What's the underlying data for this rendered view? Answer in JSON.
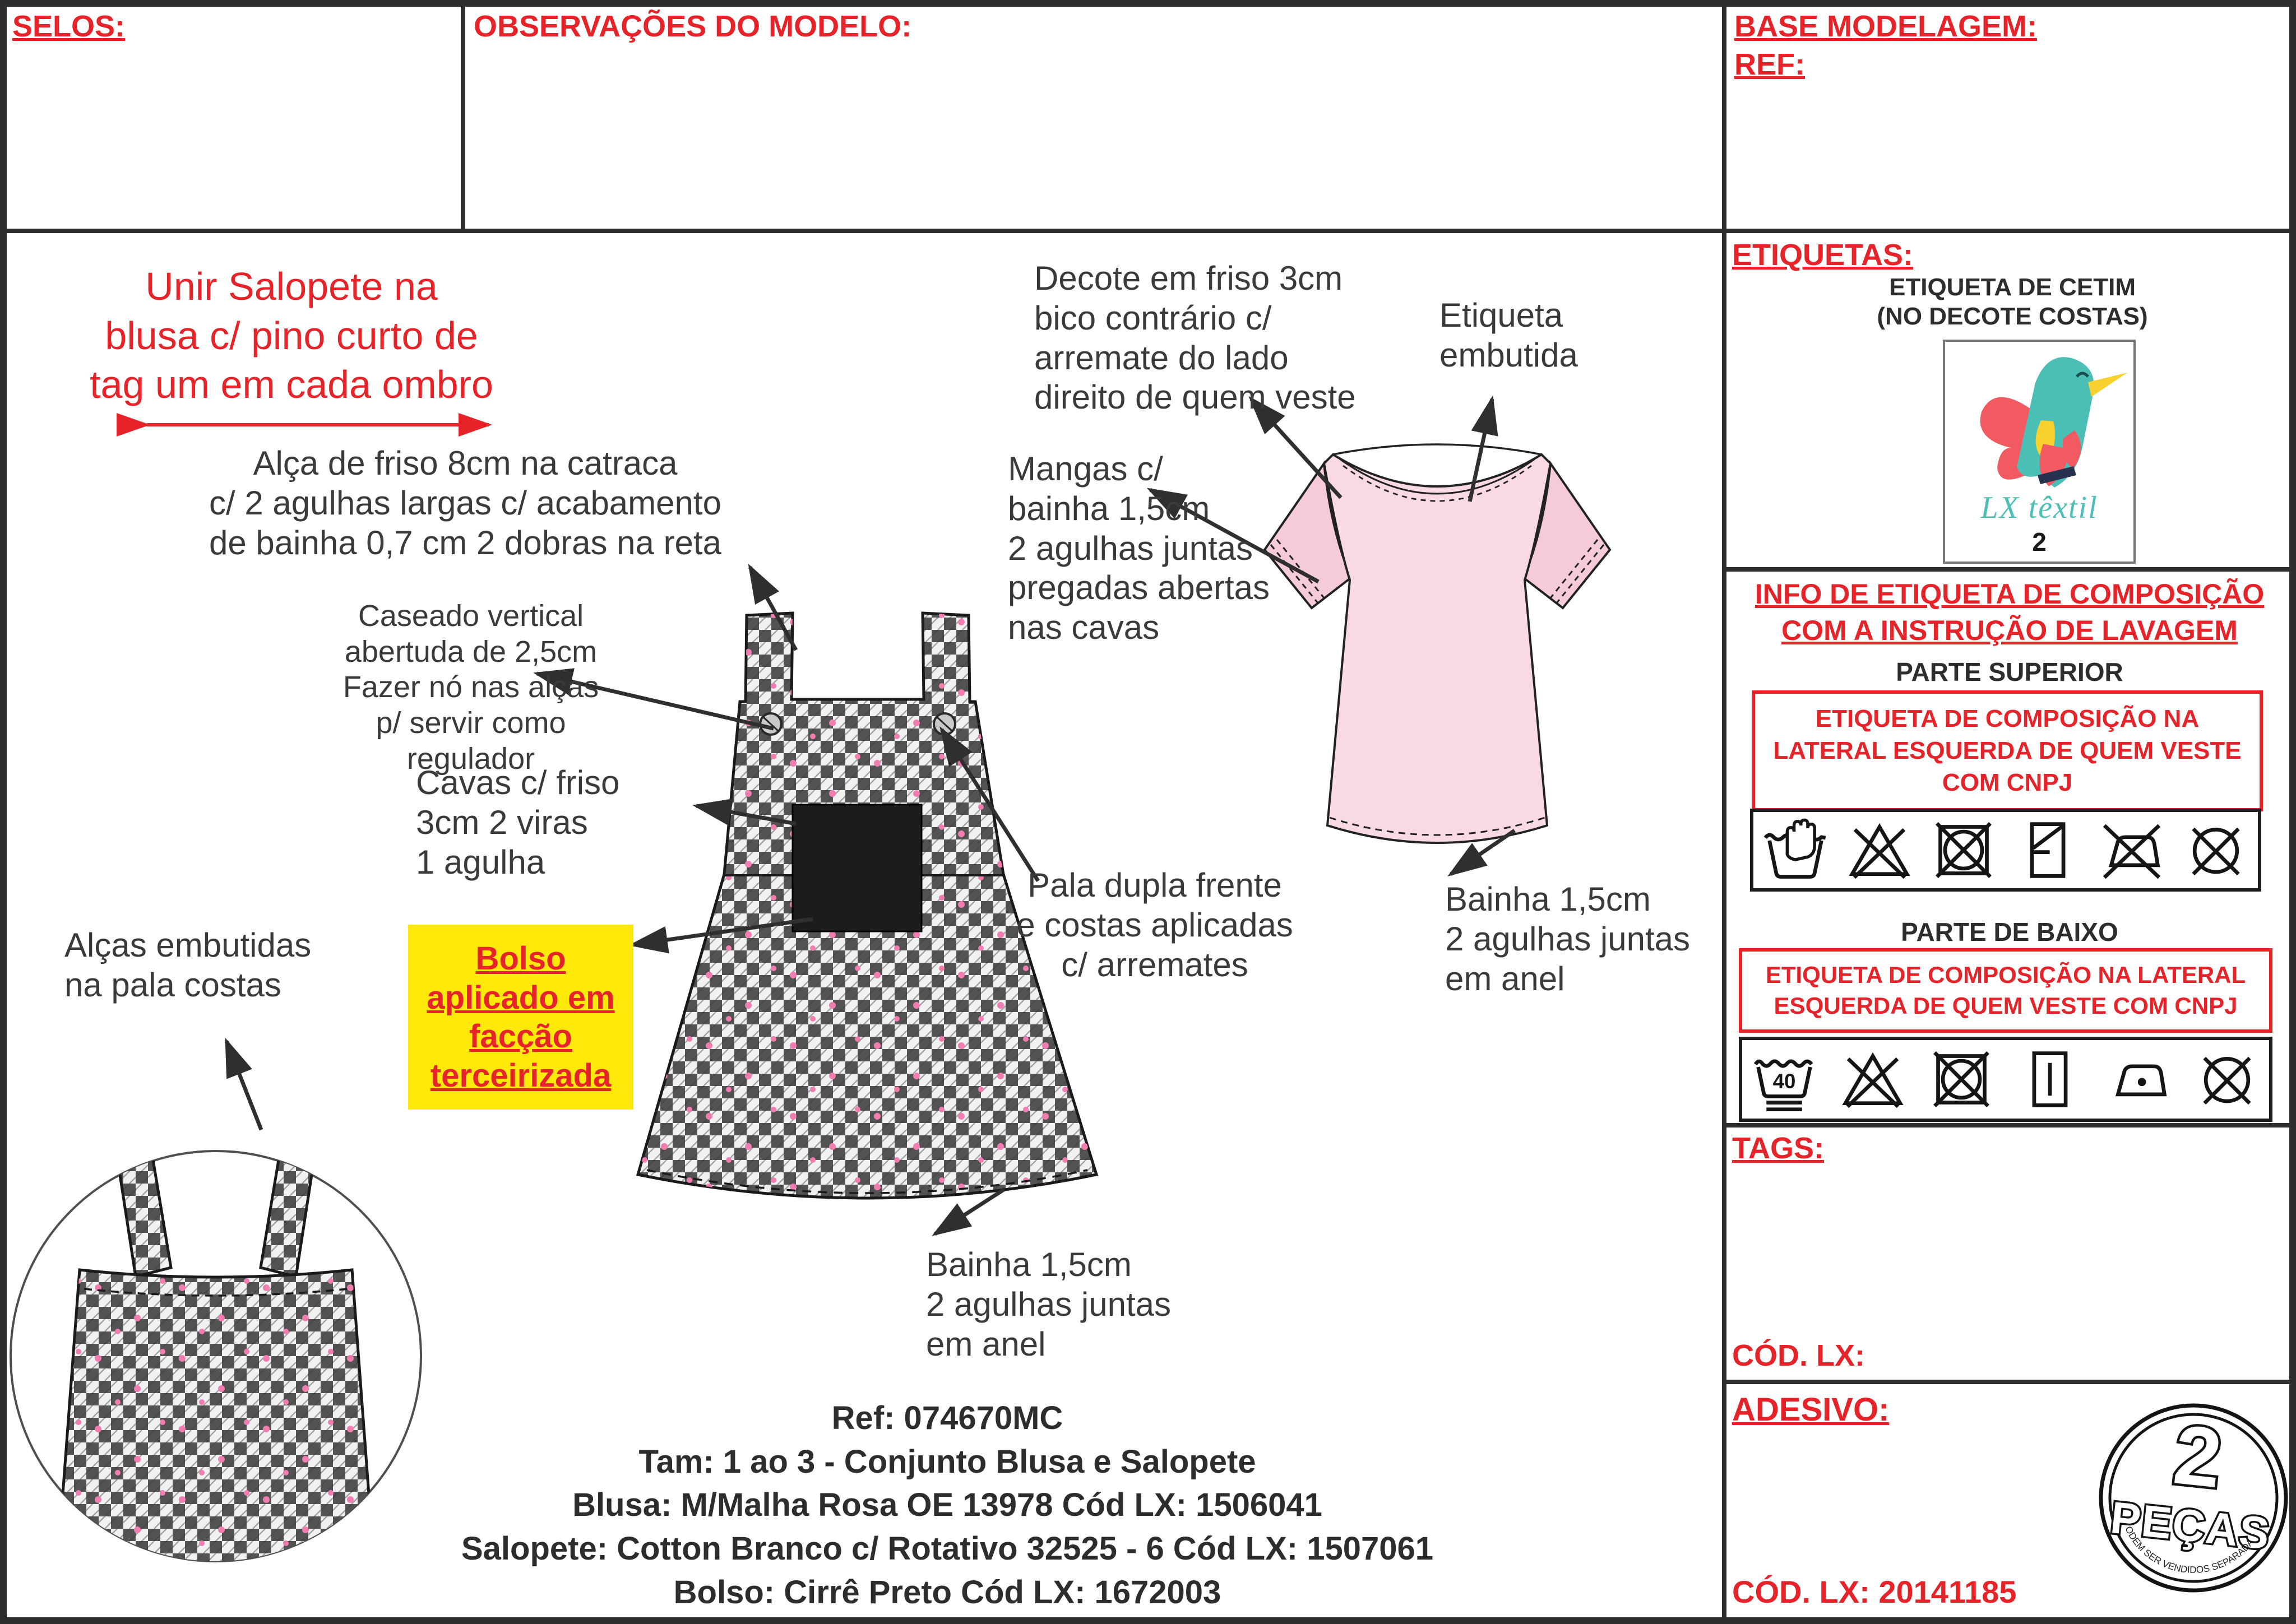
{
  "header": {
    "selos_label": "SELOS:",
    "observacoes_label": "OBSERVAÇÕES DO MODELO:",
    "base_modelagem_label": "BASE MODELAGEM:",
    "ref_label": "REF:"
  },
  "annotations": {
    "unir": "Unir Salopete na\nblusa c/ pino curto de\ntag um em cada ombro",
    "alca": "Alça de friso 8cm na catraca\nc/ 2 agulhas largas c/ acabamento\nde bainha 0,7 cm 2 dobras na reta",
    "caseado": "Caseado vertical\nabertuda de 2,5cm\nFazer nó nas alças\np/ servir como\nregulador",
    "cavas": "Cavas c/ friso\n3cm  2 viras\n1 agulha",
    "decote": "Decote em friso 3cm\nbico contrário c/\narremate do lado\ndireito de quem veste",
    "etiqueta_embutida": "Etiqueta\nembutida",
    "mangas": "Mangas c/\nbainha 1,5cm\n2 agulhas juntas\npregadas abertas\nnas cavas",
    "pala": "Pala dupla frente\ne costas aplicadas\nc/ arremates",
    "bainha_blusa": "Bainha 1,5cm\n2 agulhas juntas\nem anel",
    "bainha_salopete": "Bainha 1,5cm\n2 agulhas juntas\nem anel",
    "alcas_embutidas": "Alças embutidas\nna pala costas",
    "bolso": "Bolso\naplicado em \nfacção\nterceirizada"
  },
  "footer": {
    "lines": [
      "Ref: 074670MC",
      "Tam: 1 ao 3 - Conjunto Blusa e Salopete",
      "Blusa: M/Malha Rosa OE 13978 Cód LX: 1506041",
      "Salopete: Cotton Branco c/ Rotativo 32525 - 6 Cód LX: 1507061",
      "Bolso:  Cirrê Preto Cód LX: 1672003"
    ]
  },
  "sidebar": {
    "etiquetas": {
      "label": "ETIQUETAS:",
      "title": "ETIQUETA DE CETIM",
      "subtitle": "(NO DECOTE COSTAS)",
      "brand": "LX têxtil",
      "brand_number": "2"
    },
    "info": {
      "title": "INFO DE ETIQUETA DE COMPOSIÇÃO\nCOM A INSTRUÇÃO DE LAVAGEM",
      "parte_superior": {
        "label": "PARTE SUPERIOR",
        "note": "ETIQUETA DE COMPOSIÇÃO NA\nLATERAL ESQUERDA DE QUEM VESTE\nCOM CNPJ",
        "care_symbols": [
          "hand-wash",
          "do-not-bleach",
          "do-not-tumble-dry",
          "dry-flat-shade",
          "do-not-iron",
          "do-not-dry-clean"
        ]
      },
      "parte_baixo": {
        "label": "PARTE DE BAIXO",
        "note": "ETIQUETA DE COMPOSIÇÃO NA LATERAL\nESQUERDA DE QUEM  VESTE COM CNPJ",
        "care_symbols": [
          "wash-40-gentle",
          "do-not-bleach",
          "do-not-tumble-dry",
          "drip-dry",
          "iron-low",
          "do-not-dry-clean"
        ]
      }
    },
    "tags_label": "TAGS:",
    "cod_lx_label": "CÓD. LX:",
    "adesivo": {
      "label": "ADESIVO:",
      "stamp_number": "2",
      "stamp_word": "PEÇAS",
      "stamp_curve": "*NÃO PODEM SER VENDIDOS SEPARADAMENTE",
      "cod_lx": "CÓD. LX: 20141185"
    }
  },
  "colors": {
    "accent_red": "#e52328",
    "highlight_yellow": "#ffe90a",
    "shirt_pink": "#f9d9e6",
    "logo_teal": "#4bbfb5",
    "logo_red": "#f05a60",
    "logo_yellow": "#f8d12e",
    "plaid_dark": "#3d3d3d",
    "dot_pink": "#f27db2"
  }
}
